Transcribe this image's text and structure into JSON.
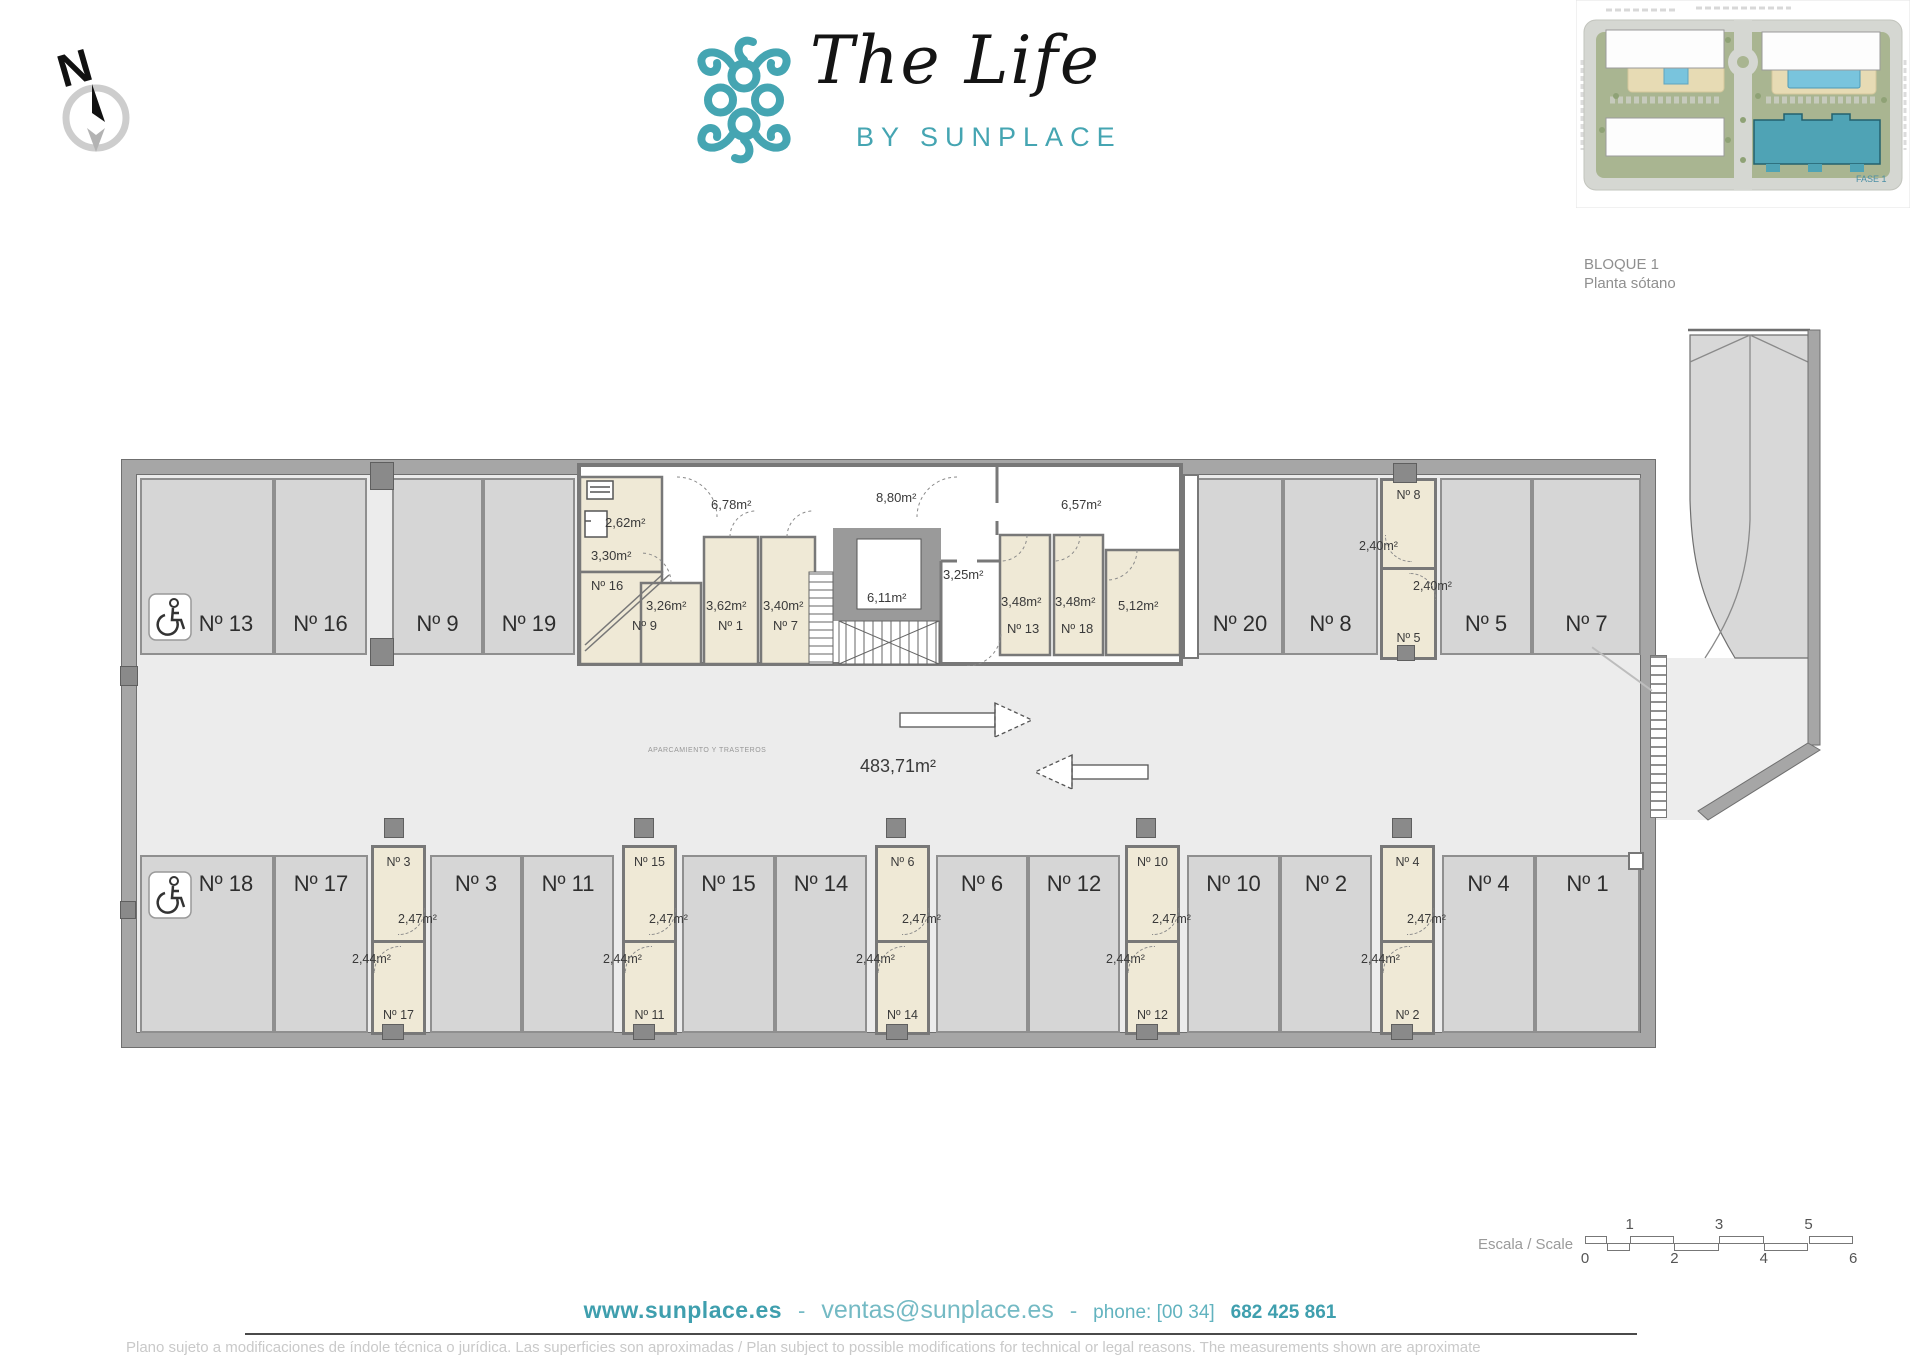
{
  "header": {
    "north_label": "N",
    "logo_title": "The Life",
    "logo_subtitle": "BY SUNPLACE",
    "block_title": "BLOQUE 1",
    "floor_title": "Planta sótano"
  },
  "site_plan": {
    "phase_label": "FASE 1"
  },
  "plan": {
    "usage_note": "APARCAMIENTO Y TRASTEROS",
    "total_area": "483,71m²",
    "top_row": [
      "Nº 13",
      "Nº 16",
      "Nº 9",
      "Nº 19",
      "Nº 20",
      "Nº 8",
      "Nº 5",
      "Nº 7"
    ],
    "bottom_row": [
      "Nº 18",
      "Nº 17",
      "Nº 3",
      "Nº 11",
      "Nº 15",
      "Nº 14",
      "Nº 6",
      "Nº 12",
      "Nº 10",
      "Nº 2",
      "Nº 4",
      "Nº 1"
    ],
    "core": {
      "r262": "2,62m²",
      "r330": "3,30m²",
      "n16": "Nº 16",
      "r326": "3,26m²",
      "n9": "Nº 9",
      "r362": "3,62m²",
      "n1": "Nº 1",
      "r340": "3,40m²",
      "n7": "Nº 7",
      "c678": "6,78m²",
      "c880": "8,80m²",
      "lift": "6,11m²",
      "vest": "3,25m²",
      "c657": "6,57m²",
      "r348a": "3,48m²",
      "n13": "Nº 13",
      "r348b": "3,48m²",
      "n18": "Nº 18",
      "r512": "5,12m²"
    },
    "storage_right": {
      "top_num": "Nº 8",
      "top_area": "2,40m²",
      "bottom_area": "2,40m²",
      "bottom_num": "Nº 5"
    },
    "storage_columns_bottom": [
      {
        "top_num": "Nº 3",
        "top_area": "2,47m²",
        "bottom_area": "2,44m²",
        "bottom_num": "Nº 17"
      },
      {
        "top_num": "Nº 15",
        "top_area": "2,47m²",
        "bottom_area": "2,44m²",
        "bottom_num": "Nº 11"
      },
      {
        "top_num": "Nº 6",
        "top_area": "2,47m²",
        "bottom_area": "2,44m²",
        "bottom_num": "Nº 14"
      },
      {
        "top_num": "Nº 10",
        "top_area": "2,47m²",
        "bottom_area": "2,44m²",
        "bottom_num": "Nº 12"
      },
      {
        "top_num": "Nº 4",
        "top_area": "2,47m²",
        "bottom_area": "2,44m²",
        "bottom_num": "Nº 2"
      }
    ]
  },
  "scale_bar": {
    "label": "Escala / Scale",
    "numbers_top": [
      "1",
      "3",
      "5"
    ],
    "numbers_bottom": [
      "0",
      "2",
      "4",
      "6"
    ]
  },
  "footer": {
    "website": "www.sunplace.es",
    "separator": "-",
    "email": "ventas@sunplace.es",
    "phone_label": "phone: [00 34]",
    "phone_number": "682 425 861",
    "disclaimer": "Plano sujeto a modificaciones de índole técnica o jurídica. Las superficies son aproximadas / Plan subject to possible modifications for technical or legal reasons. The measurements shown are aproximate"
  }
}
